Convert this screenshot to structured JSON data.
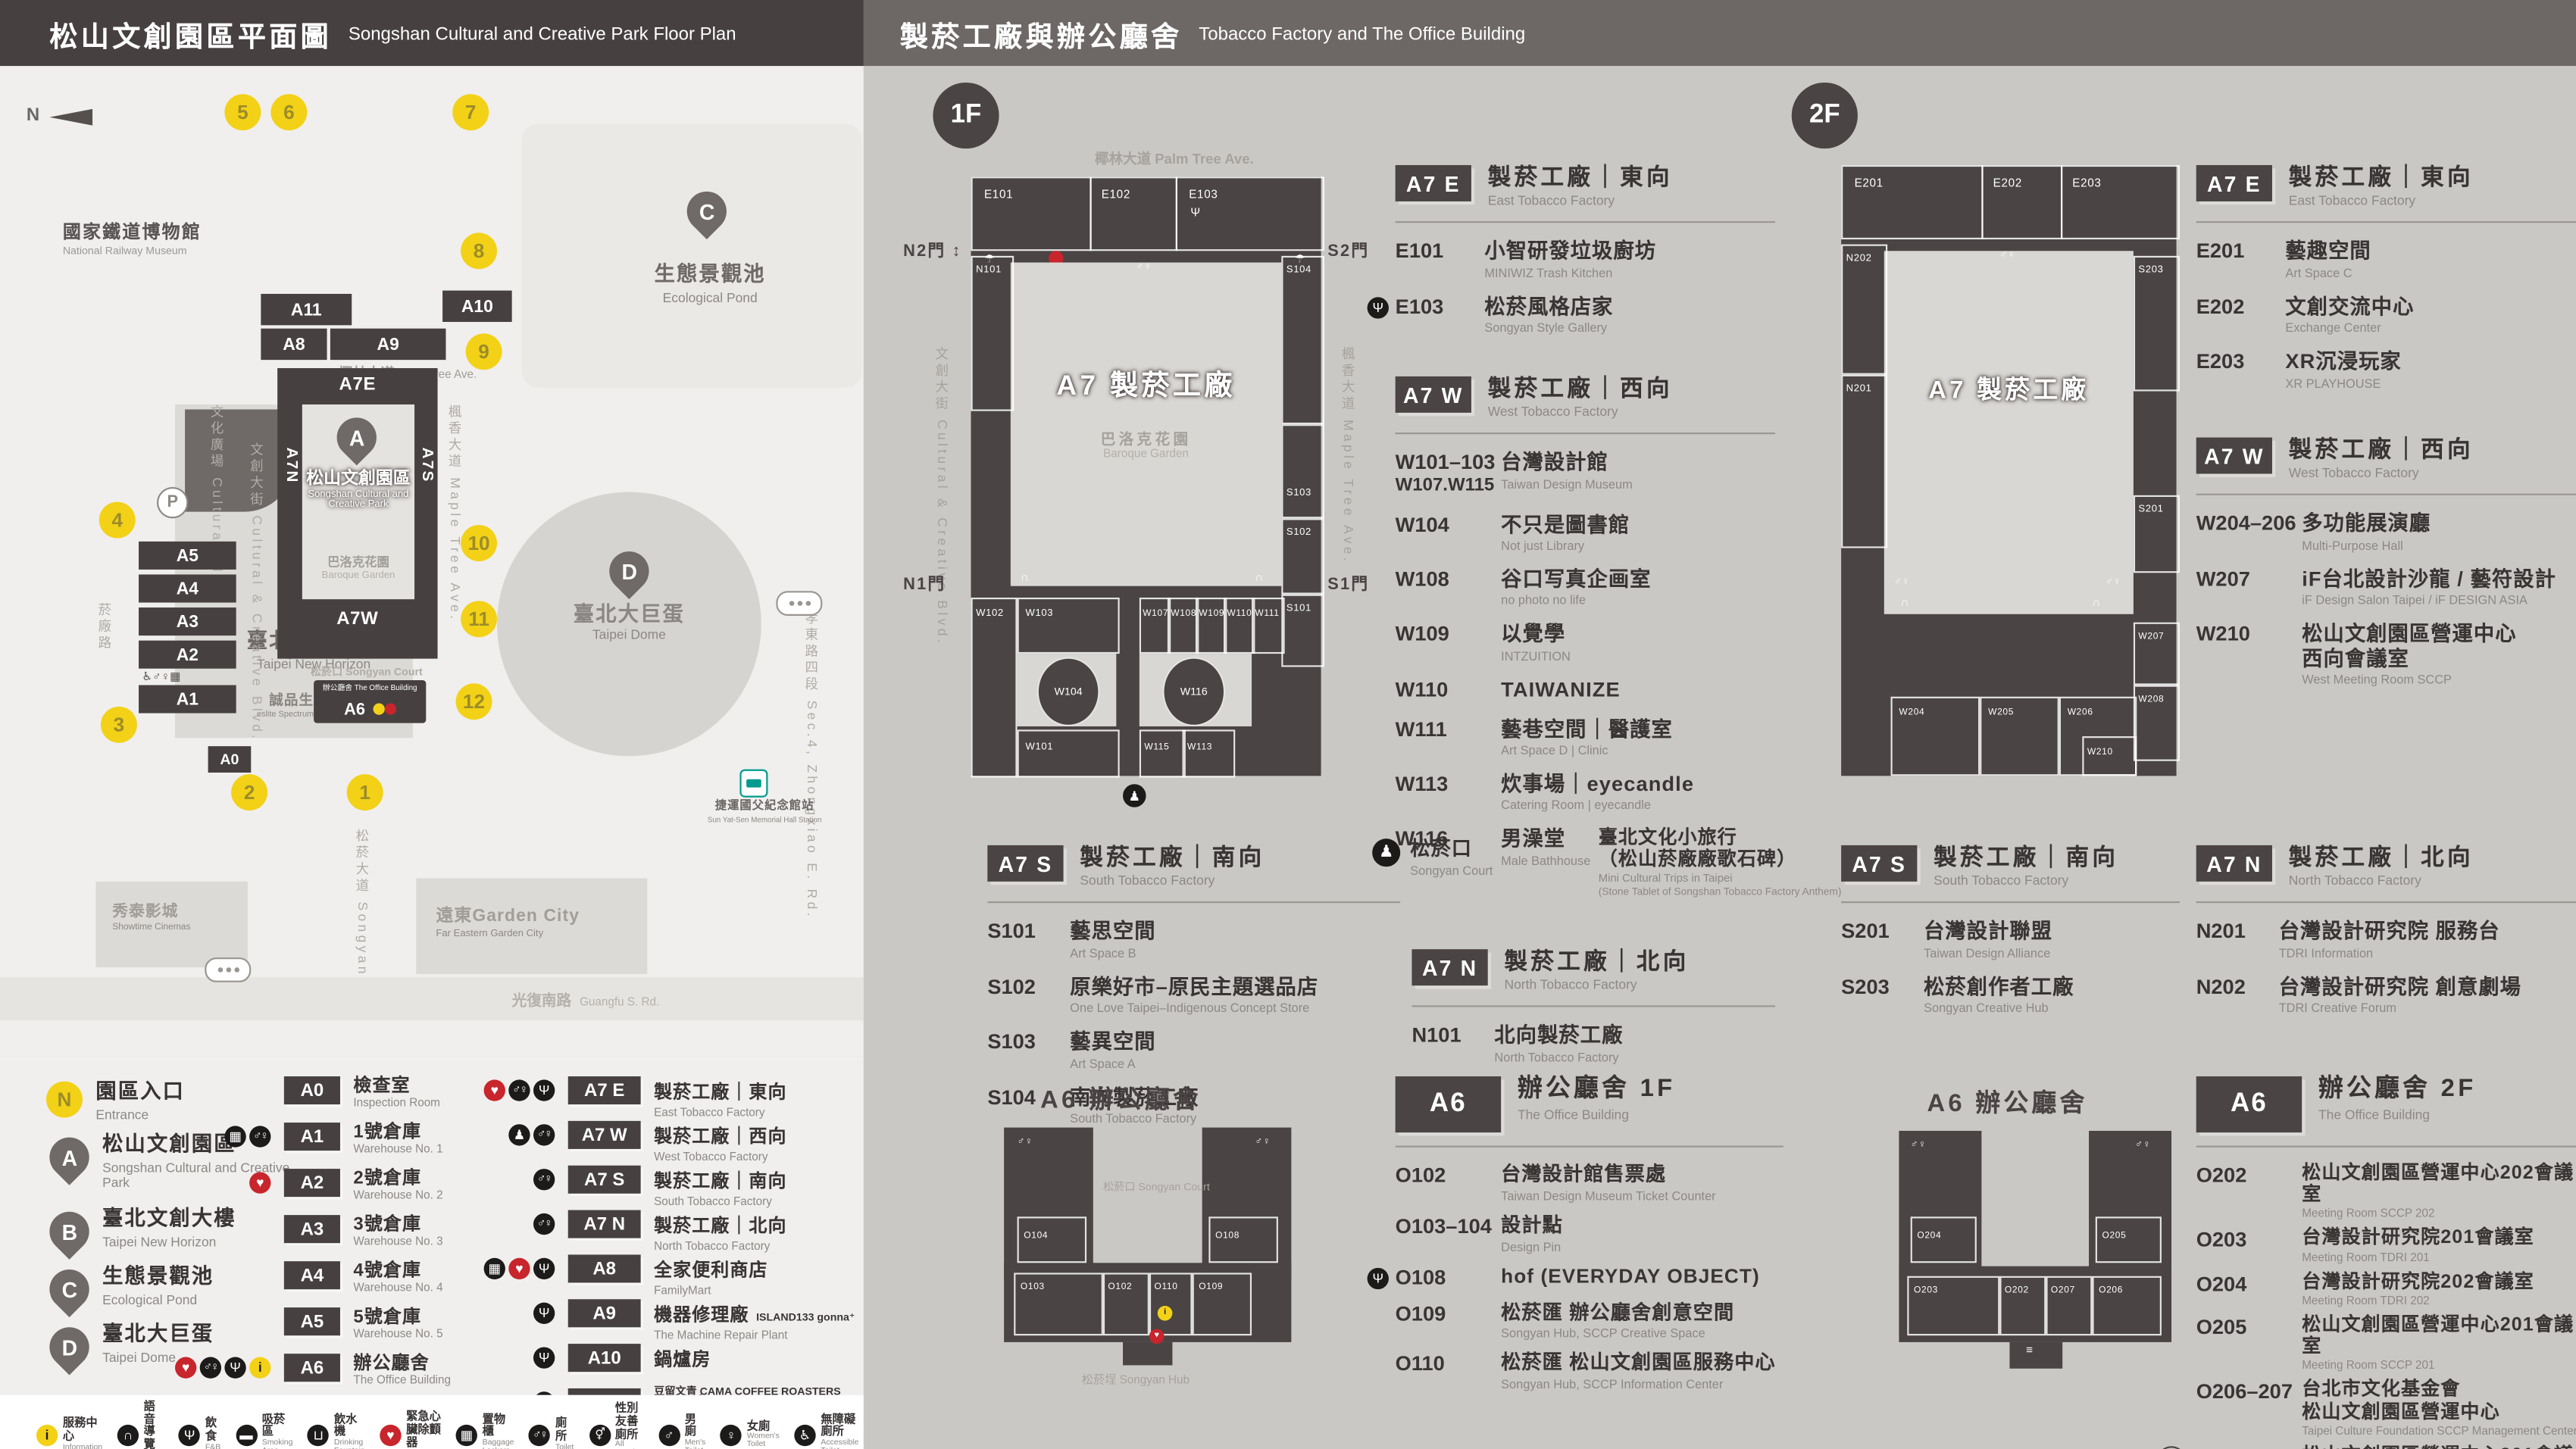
{
  "icons": {
    "info": "i",
    "audio": "∩",
    "fnb": "Ψ",
    "smoking": "▬",
    "water": "⊔",
    "aed": "♥",
    "lockers": "▦",
    "toilet": "♂♀",
    "toilet_all": "⚥",
    "male": "♂",
    "female": "♀",
    "wheelchair": "♿",
    "breastfeeding": "♡",
    "powerbank": "▮",
    "umbrella": "☂",
    "stairs": "≡",
    "goods_elevator": "▥",
    "accessible_elevator": "↕",
    "culture": "♟"
  },
  "left": {
    "header": {
      "zh": "松山文創園區平面圖",
      "en": "Songshan Cultural and Creative Park Floor Plan"
    },
    "map": {
      "north": "N",
      "railway_zh": "國家鐵道博物館",
      "railway_en": "National Railway Museum",
      "pond_sym": "C",
      "pond_zh": "生態景觀池",
      "pond_en": "Ecological Pond",
      "p": "P",
      "hotel_zh": "誠品行旅",
      "hotel_en": "eslite hotel",
      "b_sym": "B",
      "tower_zh": "臺北文創大樓",
      "tower_en": "Taipei New Horizon",
      "spectrum_zh": "誠品生活松菸",
      "spectrum_en": "eslite Spectrum Songyan Store",
      "bars": {
        "a11": "A11",
        "a10": "A10",
        "a8": "A8",
        "a9": "A9",
        "a5": "A5",
        "a4": "A4",
        "a3": "A3",
        "a2": "A2",
        "a1": "A1",
        "a0": "A0",
        "a6": "A6"
      },
      "palm_zh": "椰林大道",
      "palm_en": "Palm Tree Ave.",
      "ring": {
        "a7e": "A7E",
        "a7n": "A7N",
        "a7s": "A7S",
        "a7w": "A7W",
        "sym": "A",
        "park_zh": "松山文創園區",
        "park_en1": "Songshan Cultural and",
        "park_en2": "Creative Park",
        "garden_zh": "巴洛克花園",
        "garden_en": "Baroque Garden"
      },
      "v_cultural_plaza": "文化廣場 Cultural Plaza",
      "v_ccb": "文創大街 Cultural & Creative Blvd.",
      "v_maple": "楓香大道 Maple Tree Ave.",
      "v_yanchang": "菸廠路",
      "v_zhongxiao": "忠孝東路四段 Sec.4, Zhongxiao E. Rd.",
      "v_songyan_ave": "松菸大道 Songyan Ave.",
      "court": "松菸口 Songyan Court",
      "office_line": "辦公廳舍 The Office Building",
      "dome_sym": "D",
      "dome_zh": "臺北大巨蛋",
      "dome_en": "Taipei Dome",
      "gardencity_zh": "遠東Garden City",
      "gardencity_en": "Far Eastern Garden City",
      "cinema_zh": "秀泰影城",
      "cinema_en": "Showtime Cinemas",
      "mrt_zh": "捷運國父紀念館站",
      "mrt_en": "Sun Yat-Sen Memorial Hall Station",
      "guangfu_zh": "光復南路",
      "guangfu_en": "Guangfu S. Rd.",
      "entrances": [
        {
          "n": "1",
          "pos": "left:221px;top:440px"
        },
        {
          "n": "2",
          "pos": "left:151px;top:440px"
        },
        {
          "n": "3",
          "pos": "left:72px;top:399px"
        },
        {
          "n": "4",
          "pos": "left:71px;top:275px"
        },
        {
          "n": "5",
          "pos": "left:147px;top:28px"
        },
        {
          "n": "6",
          "pos": "left:175px;top:28px"
        },
        {
          "n": "7",
          "pos": "left:285px;top:28px"
        },
        {
          "n": "8",
          "pos": "left:290px;top:112px"
        },
        {
          "n": "9",
          "pos": "left:293px;top:173px"
        },
        {
          "n": "10",
          "pos": "left:290px;top:289px"
        },
        {
          "n": "11",
          "pos": "left:290px;top:335px"
        },
        {
          "n": "12",
          "pos": "left:287px;top:385px"
        }
      ]
    },
    "markers": [
      {
        "sym": "N",
        "type": "entrance",
        "zh": "園區入口",
        "en": "Entrance"
      },
      {
        "sym": "A",
        "type": "pin",
        "zh": "松山文創園區",
        "en": "Songshan Cultural and Creative Park"
      },
      {
        "sym": "B",
        "type": "pin",
        "zh": "臺北文創大樓",
        "en": "Taipei New Horizon"
      },
      {
        "sym": "C",
        "type": "pin",
        "zh": "生態景觀池",
        "en": "Ecological Pond"
      },
      {
        "sym": "D",
        "type": "pin",
        "zh": "臺北大巨蛋",
        "en": "Taipei Dome"
      }
    ],
    "legend_a": [
      {
        "code": "A0",
        "zh": "檢查室",
        "en": "Inspection Room",
        "icons": []
      },
      {
        "code": "A1",
        "zh": "1號倉庫",
        "en": "Warehouse No. 1",
        "icons": [
          "lockers",
          "toilet"
        ]
      },
      {
        "code": "A2",
        "zh": "2號倉庫",
        "en": "Warehouse No. 2",
        "icons": [
          "aed"
        ]
      },
      {
        "code": "A3",
        "zh": "3號倉庫",
        "en": "Warehouse No. 3",
        "icons": []
      },
      {
        "code": "A4",
        "zh": "4號倉庫",
        "en": "Warehouse No. 4",
        "icons": []
      },
      {
        "code": "A5",
        "zh": "5號倉庫",
        "en": "Warehouse No. 5",
        "icons": []
      },
      {
        "code": "A6",
        "zh": "辦公廳舍",
        "en": "The Office Building",
        "icons": [
          "aed",
          "toilet",
          "fnb",
          "info"
        ]
      }
    ],
    "legend_b": [
      {
        "code": "A7 E",
        "zh": "製菸工廠｜東向",
        "en": "East Tobacco Factory",
        "icons": [
          "aed",
          "toilet",
          "fnb"
        ]
      },
      {
        "code": "A7 W",
        "zh": "製菸工廠｜西向",
        "en": "West Tobacco Factory",
        "icons": [
          "culture",
          "toilet"
        ]
      },
      {
        "code": "A7 S",
        "zh": "製菸工廠｜南向",
        "en": "South Tobacco Factory",
        "icons": [
          "toilet"
        ]
      },
      {
        "code": "A7 N",
        "zh": "製菸工廠｜北向",
        "en": "North Tobacco Factory",
        "icons": [
          "toilet"
        ]
      },
      {
        "code": "A8",
        "zh": "全家便利商店",
        "en": "FamilyMart",
        "icons": [
          "lockers",
          "aed",
          "fnb"
        ]
      },
      {
        "code": "A9",
        "zh": "機器修理廠",
        "zh2": "ISLAND133 gonna⁺",
        "en": "The Machine Repair Plant",
        "icons": [
          "fnb"
        ]
      },
      {
        "code": "A10",
        "zh": "鍋爐房",
        "zh2": "豆留文青 CAMA COFFEE ROASTERS",
        "en": "Boiler Room",
        "icons": [
          "fnb"
        ]
      },
      {
        "code": "A11",
        "zh": "育嬰室",
        "zh2": "光一 一個時間 GUANG YIN TIME",
        "en": "The Nursery Room",
        "icons": [
          "fnb"
        ]
      }
    ]
  },
  "strip": {
    "items_left": [
      {
        "icon": "info",
        "zh": "服務中心",
        "en": "Information"
      },
      {
        "icon": "audio",
        "zh": "語音導覽",
        "en": "Audio Tour"
      },
      {
        "icon": "fnb",
        "zh": "飲食",
        "en": "F&B"
      },
      {
        "icon": "smoking",
        "zh": "吸菸區",
        "en": "Smoking Area"
      },
      {
        "icon": "water",
        "zh": "飲水機",
        "en": "Drinking Fountain"
      },
      {
        "icon": "aed",
        "zh": "緊急心臟除顫器",
        "en": "AED"
      },
      {
        "icon": "lockers",
        "zh": "置物櫃",
        "en": "Baggage Lockers"
      },
      {
        "icon": "toilet",
        "zh": "廁所",
        "en": "Toilet"
      },
      {
        "icon": "toilet_all",
        "zh": "性別友善廁所",
        "en": "All Gender Toilet"
      },
      {
        "icon": "male",
        "zh": "男廁",
        "en": "Men's Toilet"
      },
      {
        "icon": "female",
        "zh": "女廁",
        "en": "Women's Toilet"
      },
      {
        "icon": "wheelchair",
        "zh": "無障礙廁所",
        "en": "Accessible Toilet"
      }
    ],
    "items_right": [
      {
        "icon": "breastfeeding",
        "zh": "哺集乳室",
        "en": "Breastfeeding Room"
      },
      {
        "icon": "powerbank",
        "zh": "共享行動電源",
        "en": "Power Bank Rental"
      },
      {
        "icon": "umbrella",
        "zh": "共享傘",
        "en": "Umbrella Rental"
      },
      {
        "icon": "stairs",
        "zh": "階梯",
        "en": "Stairs"
      },
      {
        "icon": "goods_elevator",
        "zh": "貨梯",
        "en": "Elevator For Goods"
      },
      {
        "icon": "accessible_elevator",
        "zh": "無障礙電梯",
        "en": "Accessible Elevator"
      },
      {
        "icon": "culture",
        "zh": "臺北文化小旅行",
        "note": "(松山菸廠廠歌石碑)",
        "en": "Mini Cultural Trips in Taipei",
        "en2": "(Stone Tablet of Songshan Tobacco Factory Anthem)"
      }
    ]
  },
  "right": {
    "header": {
      "zh": "製菸工廠與辦公廳舍",
      "en": "Tobacco Factory and The Office Building"
    },
    "f1": {
      "badge": "1F",
      "plan": {
        "center": "A7 製菸工廠",
        "garden_zh": "巴洛克花園",
        "garden_en": "Baroque Garden",
        "palm": "椰林大道 Palm Tree Ave.",
        "ccb": "文創大街 Cultural & Creative Blvd.",
        "maple": "楓香大道 Maple Tree Ave.",
        "gates": {
          "n2": "N2門",
          "s2": "S2門",
          "n1": "N1門",
          "s1": "S1門"
        },
        "court_icon_label": "松菸口 Songyan Court",
        "rooms": {
          "e101": "E101",
          "e102": "E102",
          "e103": "E103",
          "n101": "N101",
          "s101": "S101",
          "s102": "S102",
          "s103": "S103",
          "s104": "S104",
          "w101": "W101",
          "w102": "W102",
          "w103": "W103",
          "w104": "W104",
          "w107": "W107",
          "w108": "W108",
          "w109": "W109",
          "w110": "W110",
          "w111": "W111",
          "w113": "W113",
          "w115": "W115",
          "w116": "W116"
        }
      },
      "a7e": {
        "code": "A7 E",
        "zh": "製菸工廠｜東向",
        "en": "East Tobacco Factory",
        "entries": [
          {
            "code": "E101",
            "zh": "小智研發垃圾廚坊",
            "en": "MINIWIZ Trash Kitchen"
          },
          {
            "icon": "fnb",
            "code": "E103",
            "zh": "松菸風格店家",
            "en": "Songyan Style Gallery"
          }
        ]
      },
      "a7w": {
        "code": "A7 W",
        "zh": "製菸工廠｜西向",
        "en": "West Tobacco Factory",
        "entries": [
          {
            "code": "W101–103",
            "code2": "W107.W115",
            "zh": "台灣設計館",
            "en": "Taiwan Design Museum"
          },
          {
            "code": "W104",
            "zh": "不只是圖書館",
            "en": "Not just Library"
          },
          {
            "code": "W108",
            "zh": "谷口写真企画室",
            "en": "no photo no life"
          },
          {
            "code": "W109",
            "zh": "以覺學",
            "en": "INTZUITION"
          },
          {
            "code": "W110",
            "zh": "TAIWANIZE"
          },
          {
            "code": "W111",
            "zh": "藝巷空間｜醫護室",
            "en": "Art Space D | Clinic"
          },
          {
            "code": "W113",
            "zh": "炊事場｜eyecandle",
            "en": "Catering Room | eyecandle"
          },
          {
            "code": "W116",
            "zh": "男澡堂",
            "en": "Male Bathhouse"
          }
        ]
      },
      "a7s": {
        "code": "A7 S",
        "zh": "製菸工廠｜南向",
        "en": "South Tobacco Factory",
        "entries": [
          {
            "code": "S101",
            "zh": "藝思空間",
            "en": "Art Space B"
          },
          {
            "code": "S102",
            "zh": "原樂好市–原民主題選品店",
            "en": "One Love Taipei–Indigenous Concept Store"
          },
          {
            "code": "S103",
            "zh": "藝異空間",
            "en": "Art Space A"
          },
          {
            "code": "S104",
            "zh": "南向製菸工廠",
            "en": "South Tobacco Factory"
          }
        ]
      },
      "court": {
        "zh": "松菸口",
        "en": "Songyan Court",
        "e_zh": "臺北文化小旅行",
        "e_zh2": "（松山菸廠廠歌石碑）",
        "e_en": "Mini Cultural Trips in Taipei",
        "e_en2": "(Stone Tablet of Songshan Tobacco Factory Anthem)"
      },
      "a7n": {
        "code": "A7 N",
        "zh": "製菸工廠｜北向",
        "en": "North Tobacco Factory",
        "entries": [
          {
            "code": "N101",
            "zh": "北向製菸工廠",
            "en": "North Tobacco Factory"
          }
        ]
      },
      "a6": {
        "badge": "A6",
        "plan_title": "A6 辦公廳舍",
        "zh": "辦公廳舍 1F",
        "en": "The Office Building",
        "court": "松菸口 Songyan Court",
        "hub": "松菸埕 Songyan Hub",
        "rooms": {
          "o102": "O102",
          "o103": "O103",
          "o104": "O104",
          "o108": "O108",
          "o109": "O109",
          "o110": "O110"
        },
        "entries": [
          {
            "code": "O102",
            "zh": "台灣設計館售票處",
            "en": "Taiwan Design Museum Ticket Counter"
          },
          {
            "code": "O103–104",
            "zh": "設計點",
            "en": "Design Pin"
          },
          {
            "icon": "fnb",
            "code": "O108",
            "zh": "hof (EVERYDAY OBJECT)"
          },
          {
            "code": "O109",
            "zh": "松菸匯 辦公廳舍創意空間",
            "en": "Songyan Hub, SCCP Creative Space"
          },
          {
            "code": "O110",
            "zh": "松菸匯 松山文創園區服務中心",
            "en": "Songyan Hub, SCCP Information Center"
          }
        ]
      }
    },
    "f2": {
      "badge": "2F",
      "plan": {
        "center": "A7 製菸工廠",
        "rooms": {
          "e201": "E201",
          "e202": "E202",
          "e203": "E203",
          "n201": "N201",
          "n202": "N202",
          "s201": "S201",
          "s203": "S203",
          "w204": "W204",
          "w205": "W205",
          "w206": "W206",
          "w207": "W207",
          "w208": "W208",
          "w210": "W210"
        }
      },
      "a7e": {
        "code": "A7 E",
        "zh": "製菸工廠｜東向",
        "en": "East Tobacco Factory",
        "entries": [
          {
            "code": "E201",
            "zh": "藝趣空間",
            "en": "Art Space C"
          },
          {
            "code": "E202",
            "zh": "文創交流中心",
            "en": "Exchange Center"
          },
          {
            "code": "E203",
            "zh": "XR沉浸玩家",
            "en": "XR PLAYHOUSE"
          }
        ]
      },
      "a7w": {
        "code": "A7 W",
        "zh": "製菸工廠｜西向",
        "en": "West Tobacco Factory",
        "entries": [
          {
            "code": "W204–206",
            "zh": "多功能展演廳",
            "en": "Multi-Purpose Hall"
          },
          {
            "code": "W207",
            "zh": "iF台北設計沙龍 / 藝符設計",
            "en": "iF Design Salon Taipei / iF DESIGN ASIA"
          },
          {
            "code": "W210",
            "zh": "松山文創園區營運中心",
            "zh2": "西向會議室",
            "en": "West Meeting Room SCCP"
          }
        ]
      },
      "a7s": {
        "code": "A7 S",
        "zh": "製菸工廠｜南向",
        "en": "South Tobacco Factory",
        "entries": [
          {
            "code": "S201",
            "zh": "台灣設計聯盟",
            "en": "Taiwan Design Alliance"
          },
          {
            "code": "S203",
            "zh": "松菸創作者工廠",
            "en": "Songyan Creative Hub"
          }
        ]
      },
      "a7n": {
        "code": "A7 N",
        "zh": "製菸工廠｜北向",
        "en": "North Tobacco Factory",
        "entries": [
          {
            "code": "N201",
            "zh": "台灣設計研究院 服務台",
            "en": "TDRI Information"
          },
          {
            "code": "N202",
            "zh": "台灣設計研究院 創意劇場",
            "en": "TDRI Creative Forum"
          }
        ]
      },
      "a6": {
        "badge": "A6",
        "plan_title": "A6 辦公廳舍",
        "zh": "辦公廳舍 2F",
        "en": "The Office Building",
        "rooms": {
          "o202": "O202",
          "o203": "O203",
          "o204": "O204",
          "o205": "O205",
          "o206": "O206",
          "o207": "O207"
        },
        "entries": [
          {
            "code": "O202",
            "zh": "松山文創園區營運中心202會議室",
            "en": "Meeting Room SCCP 202"
          },
          {
            "code": "O203",
            "zh": "台灣設計研究院201會議室",
            "en": "Meeting Room TDRI 201"
          },
          {
            "code": "O204",
            "zh": "台灣設計研究院202會議室",
            "en": "Meeting Room TDRI 202"
          },
          {
            "code": "O205",
            "zh": "松山文創園區營運中心201會議室",
            "en": "Meeting Room SCCP 201"
          },
          {
            "code": "O206–207",
            "zh": "台北市文化基金會",
            "zh2": "松山文創園區營運中心",
            "en": "Taipei Culture Foundation SCCP Management Center"
          },
          {
            "floor": "3F",
            "code": "O302",
            "zh": "松山文創園區營運中心301會議室",
            "en": "Meeting Room SCCP 301"
          }
        ]
      }
    }
  }
}
